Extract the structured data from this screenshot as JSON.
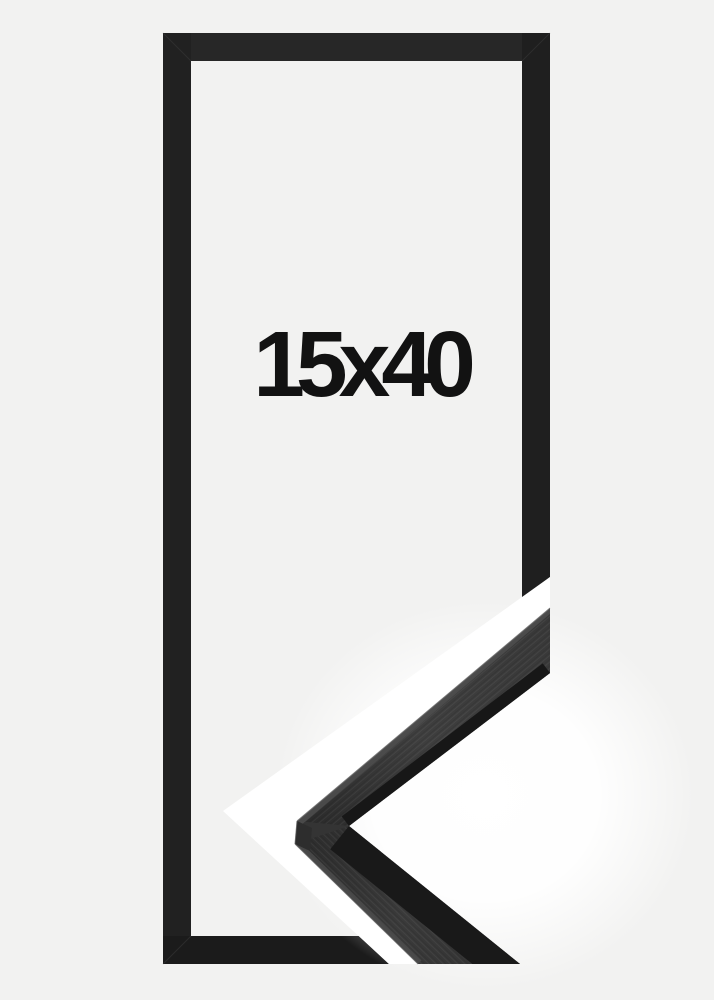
{
  "image": {
    "size_label": "15x40"
  },
  "colors": {
    "background": "#f2f2f1",
    "frame_top": "#272727",
    "frame_left": "#212121",
    "frame_right": "#1f1f1f",
    "frame_bottom": "#1b1b1b",
    "separator_band": "#ffffff",
    "moulding_base": "#343434",
    "moulding_lip": "#171717",
    "moulding_bevel": "#4f4f4f",
    "label": "#121212"
  }
}
